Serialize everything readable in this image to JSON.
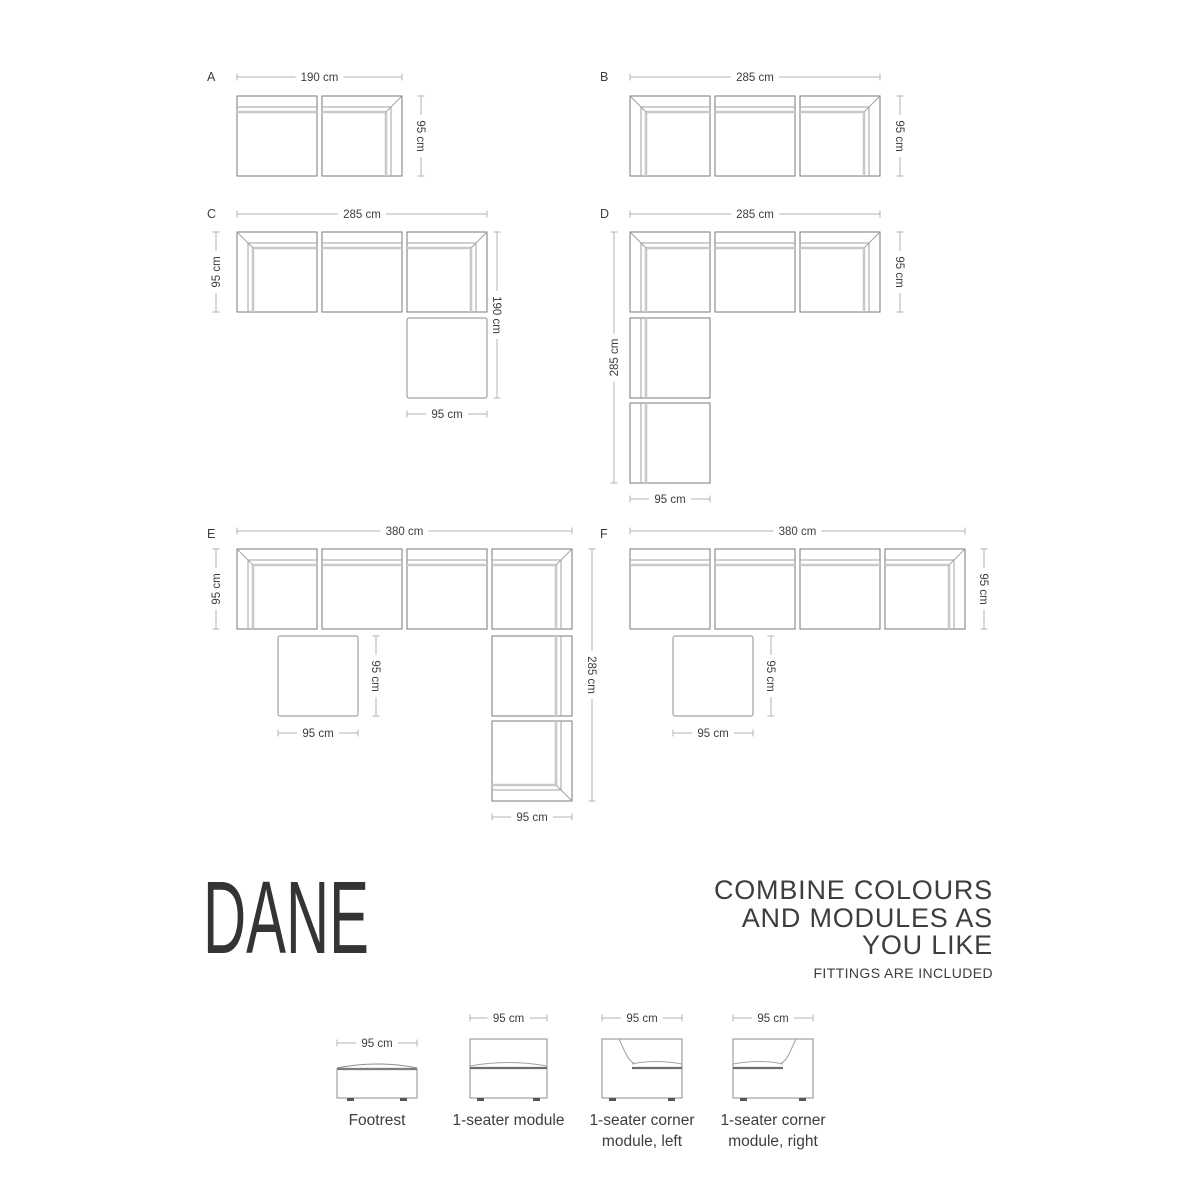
{
  "title": "DANE",
  "tagline": {
    "line1": "COMBINE COLOURS",
    "line2": "AND MODULES AS",
    "line3": "YOU LIKE",
    "note": "FITTINGS ARE INCLUDED"
  },
  "colors": {
    "outline": "#7a7a7a",
    "thin_line": "#a2a2a2",
    "thick_line": "#c9c9c9",
    "footrest_outline": "#8d8d8d",
    "dim_line": "#b3b3b3",
    "text": "#3d3d3d",
    "seat_line": "#6e6e6e",
    "feet": "#555555"
  },
  "module_size": {
    "w": 80,
    "h": 80
  },
  "configurations": [
    {
      "label": "A",
      "label_pos": [
        207,
        81
      ],
      "modules": [
        {
          "x": 237,
          "y": 96,
          "type": "seater-up"
        },
        {
          "x": 322,
          "y": 96,
          "type": "corner-right-up"
        }
      ],
      "dims": [
        {
          "text": "190 cm",
          "orient": "h",
          "x1": 237,
          "x2": 402,
          "y": 77
        },
        {
          "text": "95 cm",
          "orient": "v",
          "y1": 96,
          "y2": 176,
          "x": 421,
          "rot": 90
        }
      ]
    },
    {
      "label": "B",
      "label_pos": [
        600,
        81
      ],
      "modules": [
        {
          "x": 630,
          "y": 96,
          "type": "corner-left-up"
        },
        {
          "x": 715,
          "y": 96,
          "type": "seater-up"
        },
        {
          "x": 800,
          "y": 96,
          "type": "corner-right-up"
        }
      ],
      "dims": [
        {
          "text": "285 cm",
          "orient": "h",
          "x1": 630,
          "x2": 880,
          "y": 77
        },
        {
          "text": "95 cm",
          "orient": "v",
          "y1": 96,
          "y2": 176,
          "x": 900,
          "rot": 90
        }
      ]
    },
    {
      "label": "C",
      "label_pos": [
        207,
        218
      ],
      "modules": [
        {
          "x": 237,
          "y": 232,
          "type": "corner-left-up"
        },
        {
          "x": 322,
          "y": 232,
          "type": "seater-up"
        },
        {
          "x": 407,
          "y": 232,
          "type": "corner-right-up"
        },
        {
          "x": 407,
          "y": 318,
          "type": "footrest"
        }
      ],
      "dims": [
        {
          "text": "285 cm",
          "orient": "h",
          "x1": 237,
          "x2": 487,
          "y": 214
        },
        {
          "text": "95 cm",
          "orient": "v",
          "y1": 232,
          "y2": 312,
          "x": 216,
          "rot": -90
        },
        {
          "text": "190 cm",
          "orient": "v",
          "y1": 232,
          "y2": 398,
          "x": 497,
          "rot": 90
        },
        {
          "text": "95 cm",
          "orient": "h",
          "x1": 407,
          "x2": 487,
          "y": 414
        }
      ]
    },
    {
      "label": "D",
      "label_pos": [
        600,
        218
      ],
      "modules": [
        {
          "x": 630,
          "y": 232,
          "type": "corner-left-up"
        },
        {
          "x": 715,
          "y": 232,
          "type": "seater-up"
        },
        {
          "x": 800,
          "y": 232,
          "type": "corner-right-up"
        },
        {
          "x": 630,
          "y": 318,
          "type": "seater-left"
        },
        {
          "x": 630,
          "y": 403,
          "type": "seater-left"
        }
      ],
      "dims": [
        {
          "text": "285 cm",
          "orient": "h",
          "x1": 630,
          "x2": 880,
          "y": 214
        },
        {
          "text": "95 cm",
          "orient": "v",
          "y1": 232,
          "y2": 312,
          "x": 900,
          "rot": 90
        },
        {
          "text": "285 cm",
          "orient": "v",
          "y1": 232,
          "y2": 483,
          "x": 614,
          "rot": -90
        },
        {
          "text": "95 cm",
          "orient": "h",
          "x1": 630,
          "x2": 710,
          "y": 499
        }
      ]
    },
    {
      "label": "E",
      "label_pos": [
        207,
        538
      ],
      "modules": [
        {
          "x": 237,
          "y": 549,
          "type": "corner-left-up"
        },
        {
          "x": 322,
          "y": 549,
          "type": "seater-up"
        },
        {
          "x": 407,
          "y": 549,
          "type": "seater-up"
        },
        {
          "x": 492,
          "y": 549,
          "type": "corner-right-up"
        },
        {
          "x": 278,
          "y": 636,
          "type": "footrest"
        },
        {
          "x": 492,
          "y": 636,
          "type": "seater-right"
        },
        {
          "x": 492,
          "y": 721,
          "type": "corner-right-bottom"
        }
      ],
      "dims": [
        {
          "text": "380 cm",
          "orient": "h",
          "x1": 237,
          "x2": 572,
          "y": 531
        },
        {
          "text": "95 cm",
          "orient": "v",
          "y1": 549,
          "y2": 629,
          "x": 216,
          "rot": -90
        },
        {
          "text": "95 cm",
          "orient": "v",
          "y1": 636,
          "y2": 716,
          "x": 376,
          "rot": 90
        },
        {
          "text": "95 cm",
          "orient": "h",
          "x1": 278,
          "x2": 358,
          "y": 733
        },
        {
          "text": "285 cm",
          "orient": "v",
          "y1": 549,
          "y2": 801,
          "x": 592,
          "rot": 90
        },
        {
          "text": "95 cm",
          "orient": "h",
          "x1": 492,
          "x2": 572,
          "y": 817
        }
      ]
    },
    {
      "label": "F",
      "label_pos": [
        600,
        538
      ],
      "modules": [
        {
          "x": 630,
          "y": 549,
          "type": "seater-up"
        },
        {
          "x": 715,
          "y": 549,
          "type": "seater-up"
        },
        {
          "x": 800,
          "y": 549,
          "type": "seater-up"
        },
        {
          "x": 885,
          "y": 549,
          "type": "corner-right-up"
        },
        {
          "x": 673,
          "y": 636,
          "type": "footrest"
        }
      ],
      "dims": [
        {
          "text": "380 cm",
          "orient": "h",
          "x1": 630,
          "x2": 965,
          "y": 531
        },
        {
          "text": "95 cm",
          "orient": "v",
          "y1": 549,
          "y2": 629,
          "x": 984,
          "rot": 90
        },
        {
          "text": "95 cm",
          "orient": "v",
          "y1": 636,
          "y2": 716,
          "x": 771,
          "rot": 90
        },
        {
          "text": "95 cm",
          "orient": "h",
          "x1": 673,
          "x2": 753,
          "y": 733
        }
      ]
    }
  ],
  "legend": {
    "items": [
      {
        "type": "footrest-elev",
        "x": 337,
        "w": 80,
        "dim_text": "95 cm",
        "dim_y": 1043,
        "label_lines": [
          "Footrest"
        ]
      },
      {
        "type": "seater-elev",
        "x": 470,
        "w": 77,
        "dim_text": "95 cm",
        "dim_y": 1018,
        "label_lines": [
          "1-seater module"
        ]
      },
      {
        "type": "corner-left-elev",
        "x": 602,
        "w": 80,
        "dim_text": "95 cm",
        "dim_y": 1018,
        "label_lines": [
          "1-seater corner",
          "module, left"
        ]
      },
      {
        "type": "corner-right-elev",
        "x": 733,
        "w": 80,
        "dim_text": "95 cm",
        "dim_y": 1018,
        "label_lines": [
          "1-seater corner",
          "module, right"
        ]
      }
    ],
    "label_baseline1": 1125,
    "label_baseline2": 1146
  }
}
